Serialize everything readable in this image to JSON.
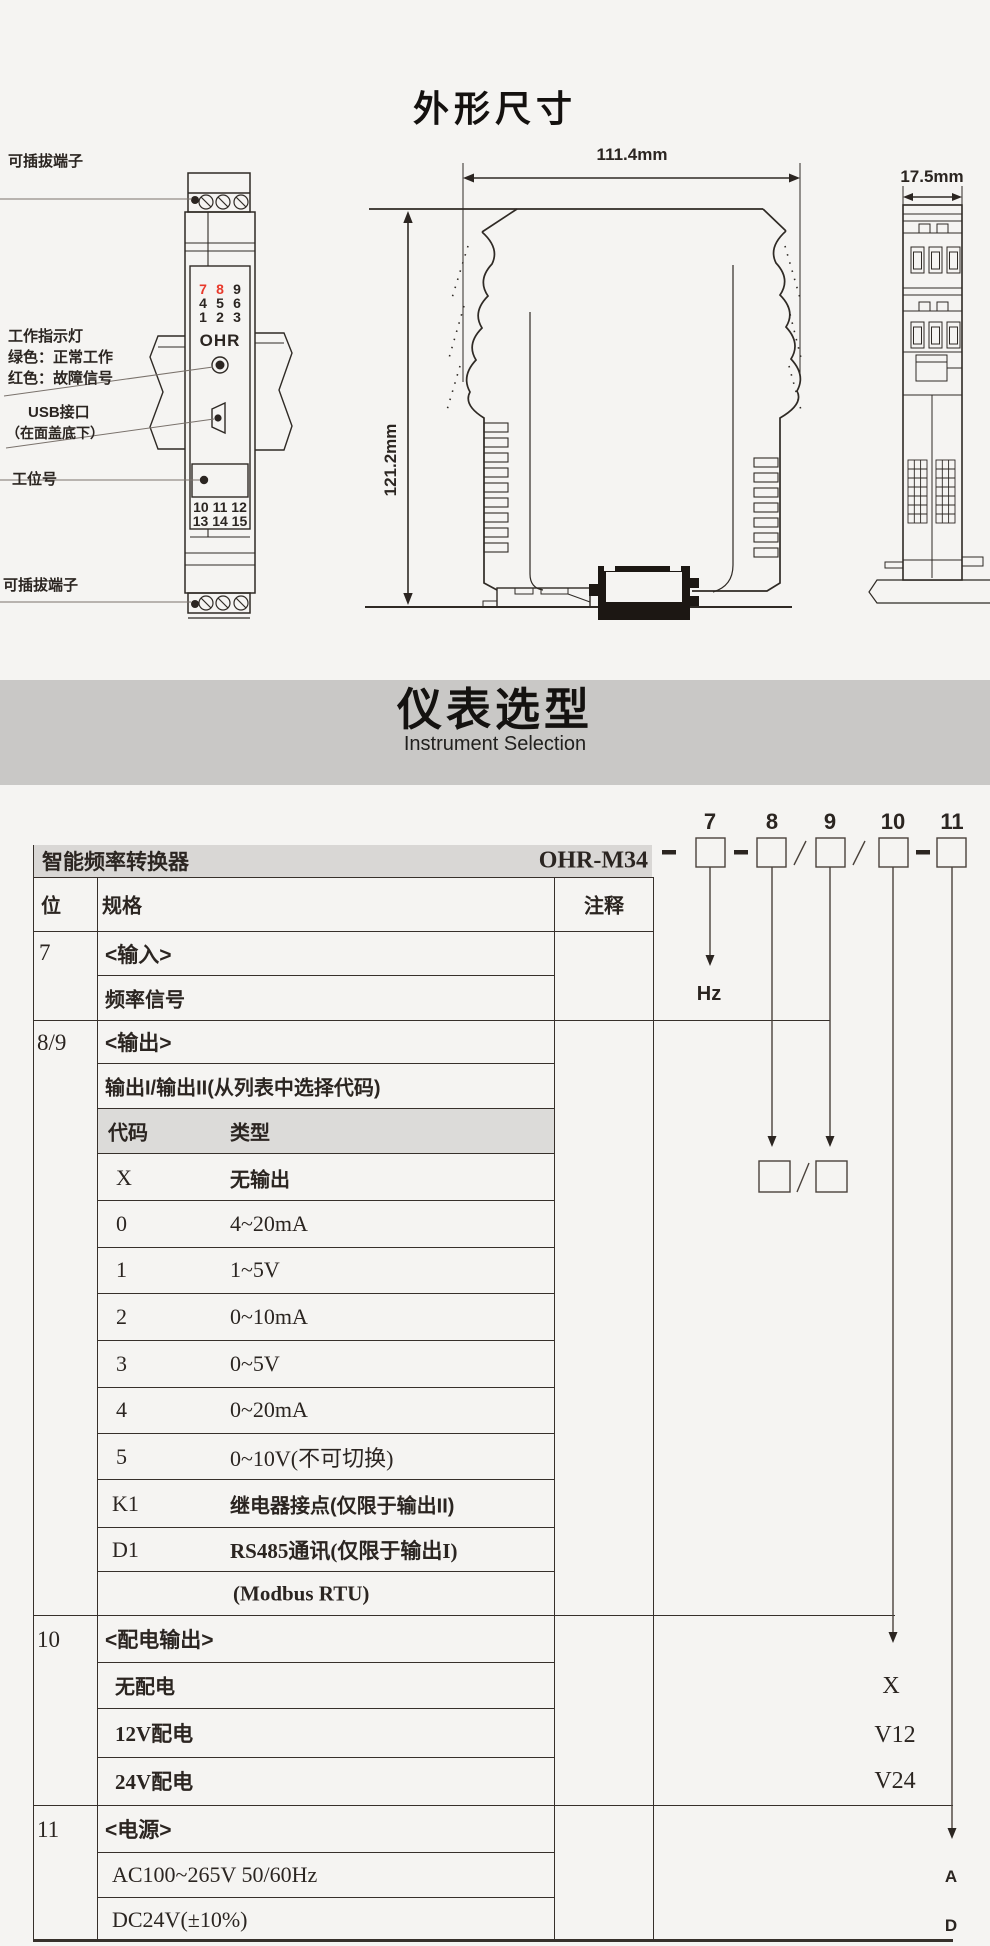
{
  "colors": {
    "accent_red": "#e8392b",
    "banner_gray": "#c9c8c6",
    "strip_gray": "#d9d7d5"
  },
  "outline": {
    "title": "外形尺寸",
    "front_view": {
      "plug_top": "可插拔端子",
      "indicator_line1": "工作指示灯",
      "indicator_line2": "绿色：正常工作",
      "indicator_line3": "红色：故障信号",
      "usb_line1": "USB接口",
      "usb_line2": "（在面盖底下）",
      "station_label": "工位号",
      "plug_bottom": "可插拔端子",
      "logo": "OHR",
      "led_label": "EVT1",
      "terms_top": [
        [
          "7",
          "8",
          "9"
        ],
        [
          "4",
          "5",
          "6"
        ],
        [
          "1",
          "2",
          "3"
        ]
      ],
      "terms_bottom": [
        "10 11 12",
        "13 14 15"
      ]
    },
    "side_view": {
      "width_dim": "111.4mm",
      "height_dim": "121.2mm"
    },
    "top_view": {
      "width_dim": "17.5mm"
    }
  },
  "banner": {
    "title": "仪表选型",
    "subtitle": "Instrument Selection"
  },
  "selection": {
    "product_name": "智能频率转换器",
    "model": "OHR-M34",
    "digits": [
      "7",
      "8",
      "9",
      "10",
      "11"
    ],
    "hz_label": "Hz",
    "headers": {
      "bit": "位",
      "spec": "规格",
      "note": "注释"
    },
    "s7": {
      "bit": "7",
      "r1": "<输入>",
      "r2": "频率信号"
    },
    "s89": {
      "bit": "8/9",
      "r1": "<输出>",
      "r2": "输出I/输出II(从列表中选择代码)",
      "ch_code": "代码",
      "ch_type": "类型",
      "codes": [
        [
          "X",
          "无输出"
        ],
        [
          "0",
          "4~20mA"
        ],
        [
          "1",
          "1~5V"
        ],
        [
          "2",
          "0~10mA"
        ],
        [
          "3",
          "0~5V"
        ],
        [
          "4",
          "0~20mA"
        ],
        [
          "5",
          "0~10V(不可切换)"
        ],
        [
          "K1",
          "继电器接点(仅限于输出II)"
        ],
        [
          "D1",
          "RS485通讯(仅限于输出I)"
        ],
        [
          "",
          "(Modbus RTU)"
        ]
      ]
    },
    "s10": {
      "bit": "10",
      "r1": "<配电输出>",
      "rows": [
        "无配电",
        "12V配电",
        "24V配电"
      ],
      "codes": [
        "X",
        "V12",
        "V24"
      ]
    },
    "s11": {
      "bit": "11",
      "r1": "<电源>",
      "rows": [
        "AC100~265V 50/60Hz",
        "DC24V(±10%)"
      ],
      "codes": [
        "A",
        "D"
      ]
    }
  }
}
